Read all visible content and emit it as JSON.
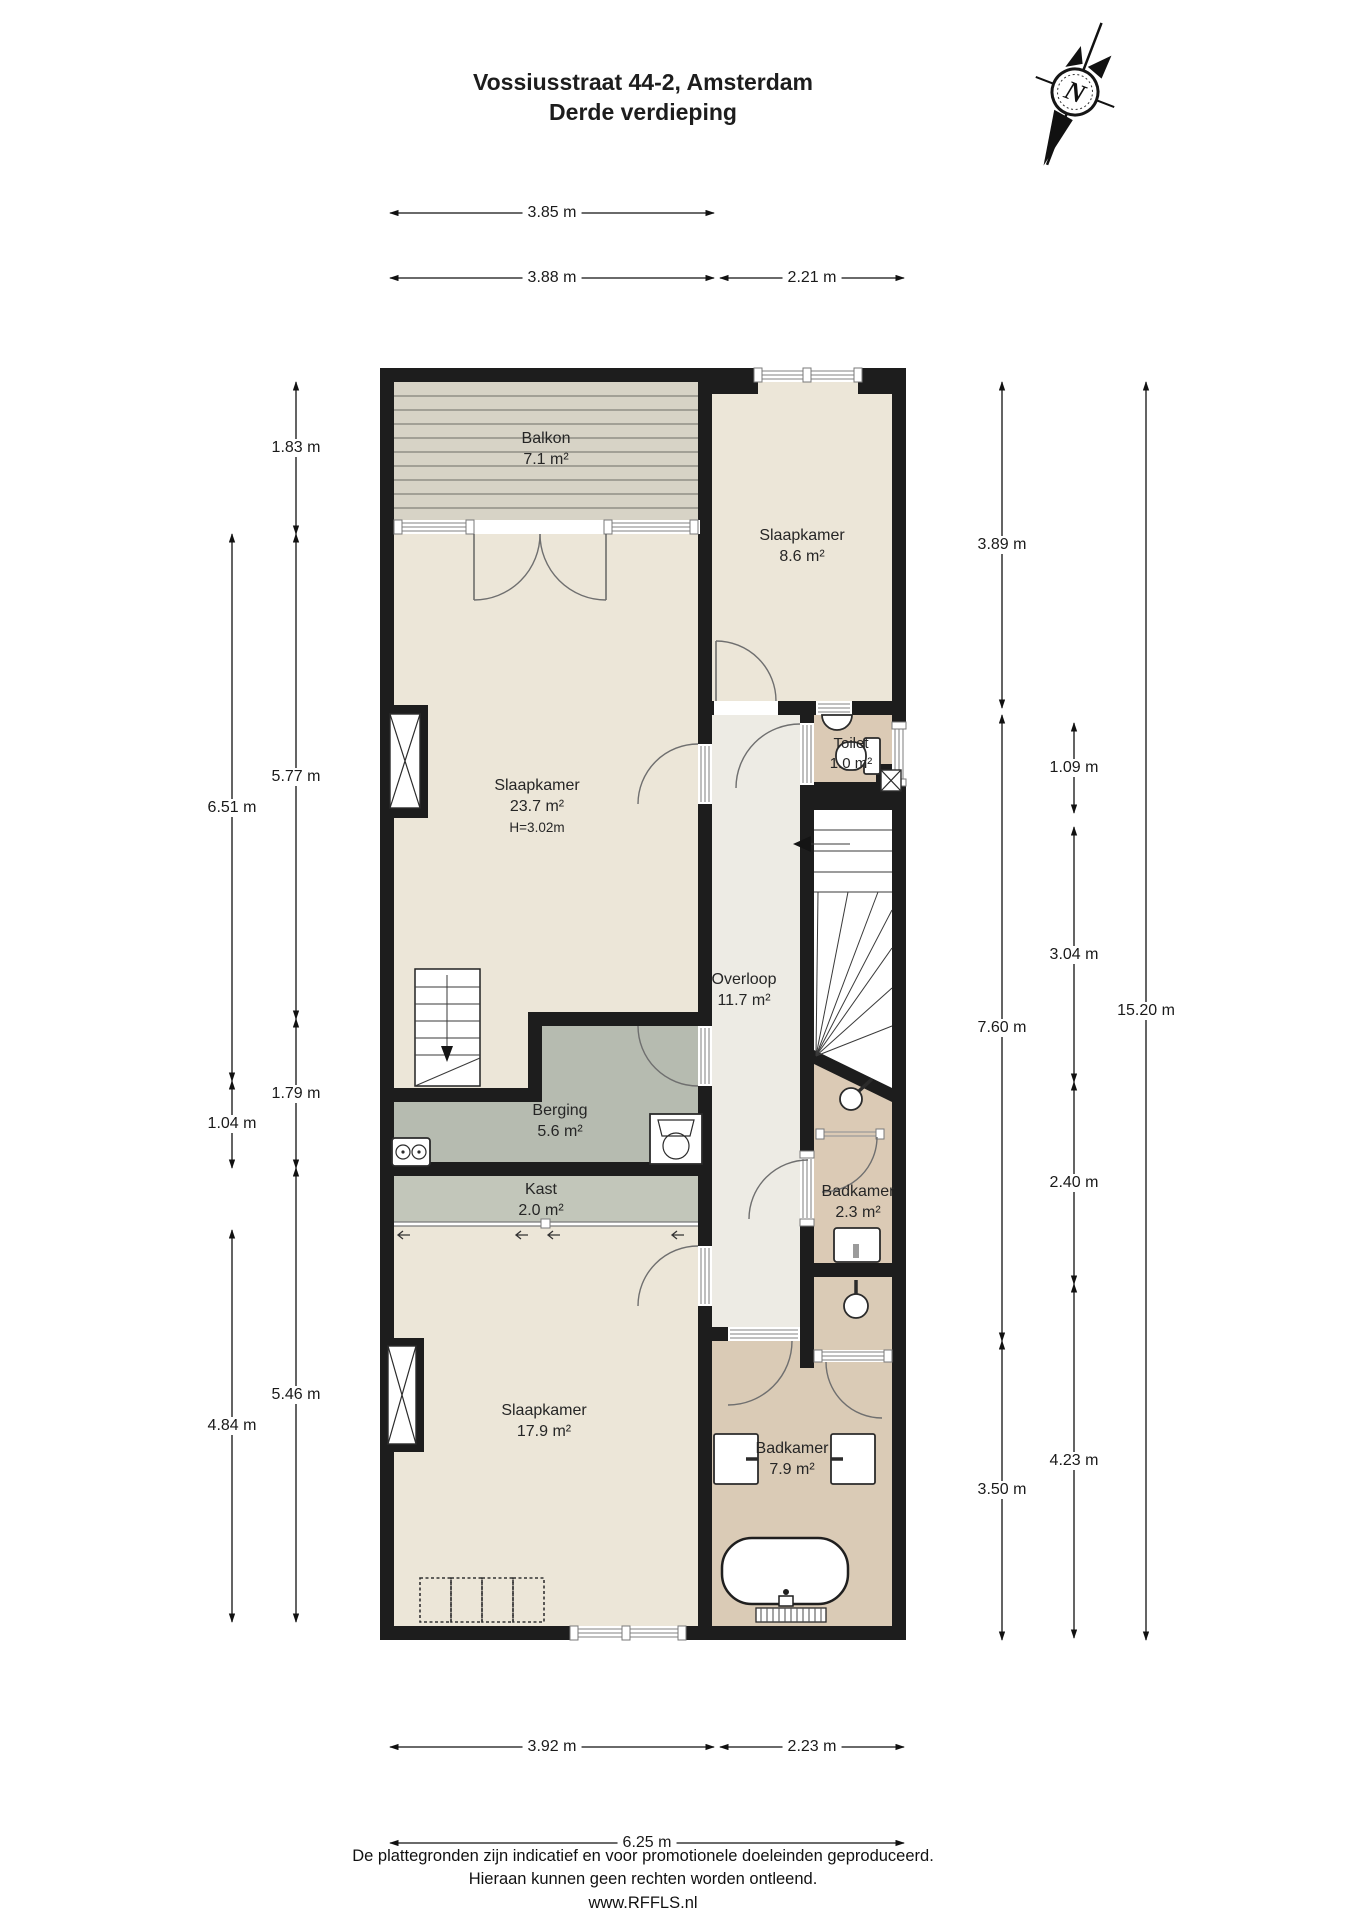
{
  "title": {
    "line1": "Vossiusstraat 44-2, Amsterdam",
    "line2": "Derde verdieping"
  },
  "compass": {
    "north_label": "N"
  },
  "rooms": {
    "balkon": {
      "name": "Balkon",
      "area": "7.1 m²"
    },
    "slaapkamer_boven": {
      "name": "Slaapkamer",
      "area": "8.6 m²"
    },
    "slaapkamer_groot": {
      "name": "Slaapkamer",
      "area": "23.7 m²",
      "height_note": "H=3.02m"
    },
    "toilet": {
      "name": "Toilet",
      "area": "1.0 m²"
    },
    "overloop": {
      "name": "Overloop",
      "area": "11.7 m²"
    },
    "berging": {
      "name": "Berging",
      "area": "5.6 m²"
    },
    "kast": {
      "name": "Kast",
      "area": "2.0 m²"
    },
    "badkamer_klein": {
      "name": "Badkamer",
      "area": "2.3 m²"
    },
    "slaapkamer_onder": {
      "name": "Slaapkamer",
      "area": "17.9 m²"
    },
    "badkamer_groot": {
      "name": "Badkamer",
      "area": "7.9 m²"
    }
  },
  "dimensions": {
    "top": [
      "3.85 m",
      "3.88 m",
      "2.21 m"
    ],
    "bottom": [
      "3.92 m",
      "2.23 m",
      "6.25 m"
    ],
    "left_outer": [
      "6.51 m",
      "1.04 m",
      "4.84 m"
    ],
    "left_inner": [
      "1.83 m",
      "5.77 m",
      "1.79 m",
      "5.46 m"
    ],
    "right_col_a": [
      "3.89 m",
      "7.60 m",
      "3.50 m"
    ],
    "right_col_b": [
      "1.09 m",
      "3.04 m",
      "2.40 m",
      "4.23 m"
    ],
    "right_col_c": [
      "15.20 m"
    ]
  },
  "footer": {
    "line1": "De plattegronden zijn indicatief en voor promotionele doeleinden geproduceerd.",
    "line2": "Hieraan kunnen geen rechten worden ontleend.",
    "line3": "www.RFFLS.nl"
  },
  "colors": {
    "wall": "#1d1d1d",
    "bedroom_fill": "#ece6d8",
    "balcony_fill": "#d7d3c6",
    "hallway_fill": "#edebe4",
    "bathroom_fill": "#dbcab5",
    "storage_fill": "#b6bbb0",
    "closet_fill": "#c2c6ba",
    "background": "#ffffff"
  }
}
